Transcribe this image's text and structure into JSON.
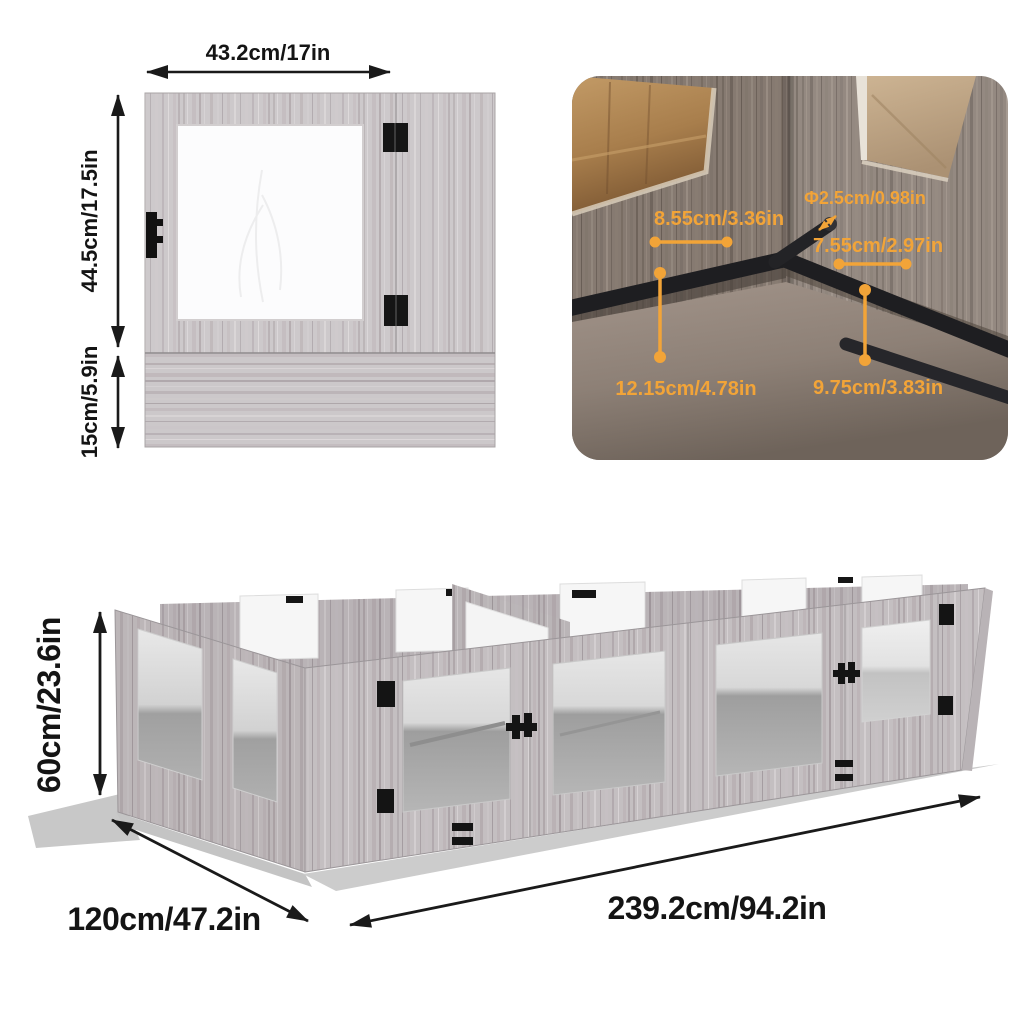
{
  "panel_diagram": {
    "width_label": "43.2cm/17in",
    "upper_height_label": "44.5cm/17.5in",
    "lower_height_label": "15cm/5.9in"
  },
  "corner_photo": {
    "diameter_label": "Φ2.5cm/0.98in",
    "left_bar_length_label": "8.55cm/3.36in",
    "right_bar_length_label": "7.55cm/2.97in",
    "left_height_label": "12.15cm/4.78in",
    "right_height_label": "9.75cm/3.83in",
    "accent_color": "#F2A438"
  },
  "assembled_diagram": {
    "height_label": "60cm/23.6in",
    "depth_label": "120cm/47.2in",
    "length_label": "239.2cm/94.2in"
  }
}
